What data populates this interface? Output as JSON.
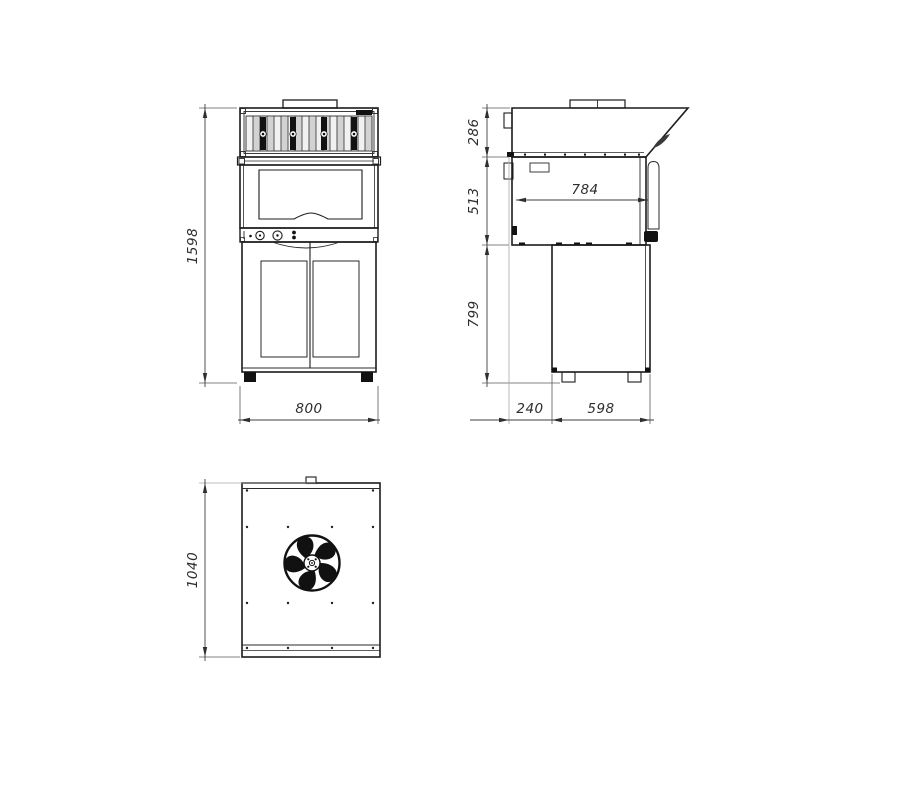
{
  "dimensions": {
    "front_height": "1598",
    "front_width": "800",
    "side_hood_height": "286",
    "side_body_height": "513",
    "side_base_height": "799",
    "side_inner_depth": "784",
    "side_rear_offset": "240",
    "side_base_depth": "598",
    "top_depth": "1040"
  },
  "colors": {
    "background": "#ffffff",
    "outline": "#1c1c1c",
    "dimension_line": "#3f3f3f",
    "text": "#2d2d2d"
  }
}
